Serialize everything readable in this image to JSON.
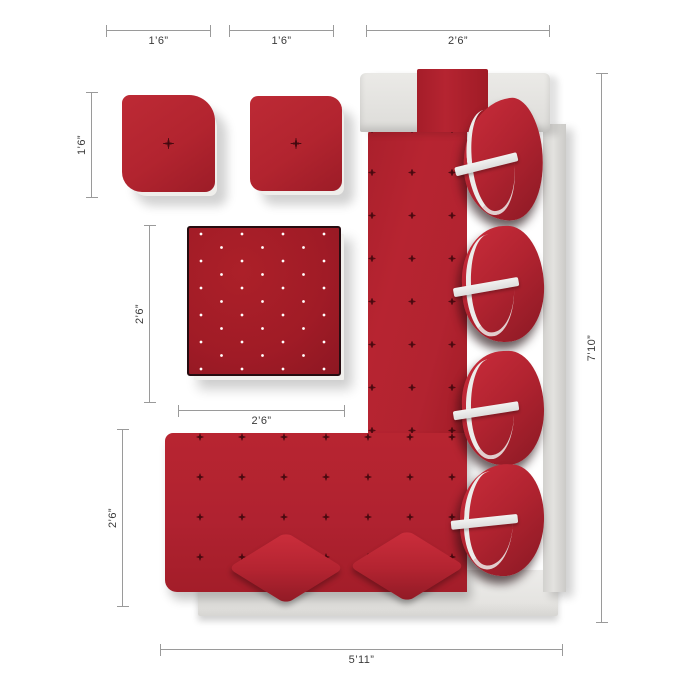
{
  "diagram": {
    "type": "furniture-top-view-dimension-diagram",
    "subject": "red tufted L-shaped sectional sofa set with ottomans and pillows"
  },
  "dimensions": {
    "ottoman1_width": {
      "label": "1’6”"
    },
    "ottoman2_width": {
      "label": "1’6”"
    },
    "chaise_width": {
      "label": "2’6”"
    },
    "ottoman_depth": {
      "label": "1’6”"
    },
    "storage_ottoman_depth": {
      "label": "2’6”"
    },
    "storage_ottoman_width": {
      "label": "2’6”"
    },
    "sofa_seat_depth": {
      "label": "2’6”"
    },
    "sofa_length": {
      "label": "7’10”"
    },
    "sofa_width": {
      "label": "5’11”"
    }
  },
  "colors": {
    "upholstery_red": "#b22330",
    "tufted_ottoman_red": "#a01b26",
    "frame_white": "#e8e7e4",
    "strap_white": "#ececea",
    "dimension_line": "#9a9a9a",
    "label_text": "#3a3a3a",
    "background": "#ffffff"
  },
  "furniture": {
    "pieces": [
      "small-square-ottoman",
      "small-square-ottoman",
      "button-tufted-storage-ottoman",
      "l-shaped-sectional-sofa",
      "back-pillow-with-strap",
      "back-pillow-with-strap",
      "back-pillow-with-strap",
      "back-pillow-with-strap",
      "diamond-throw-pillow",
      "diamond-throw-pillow"
    ]
  }
}
